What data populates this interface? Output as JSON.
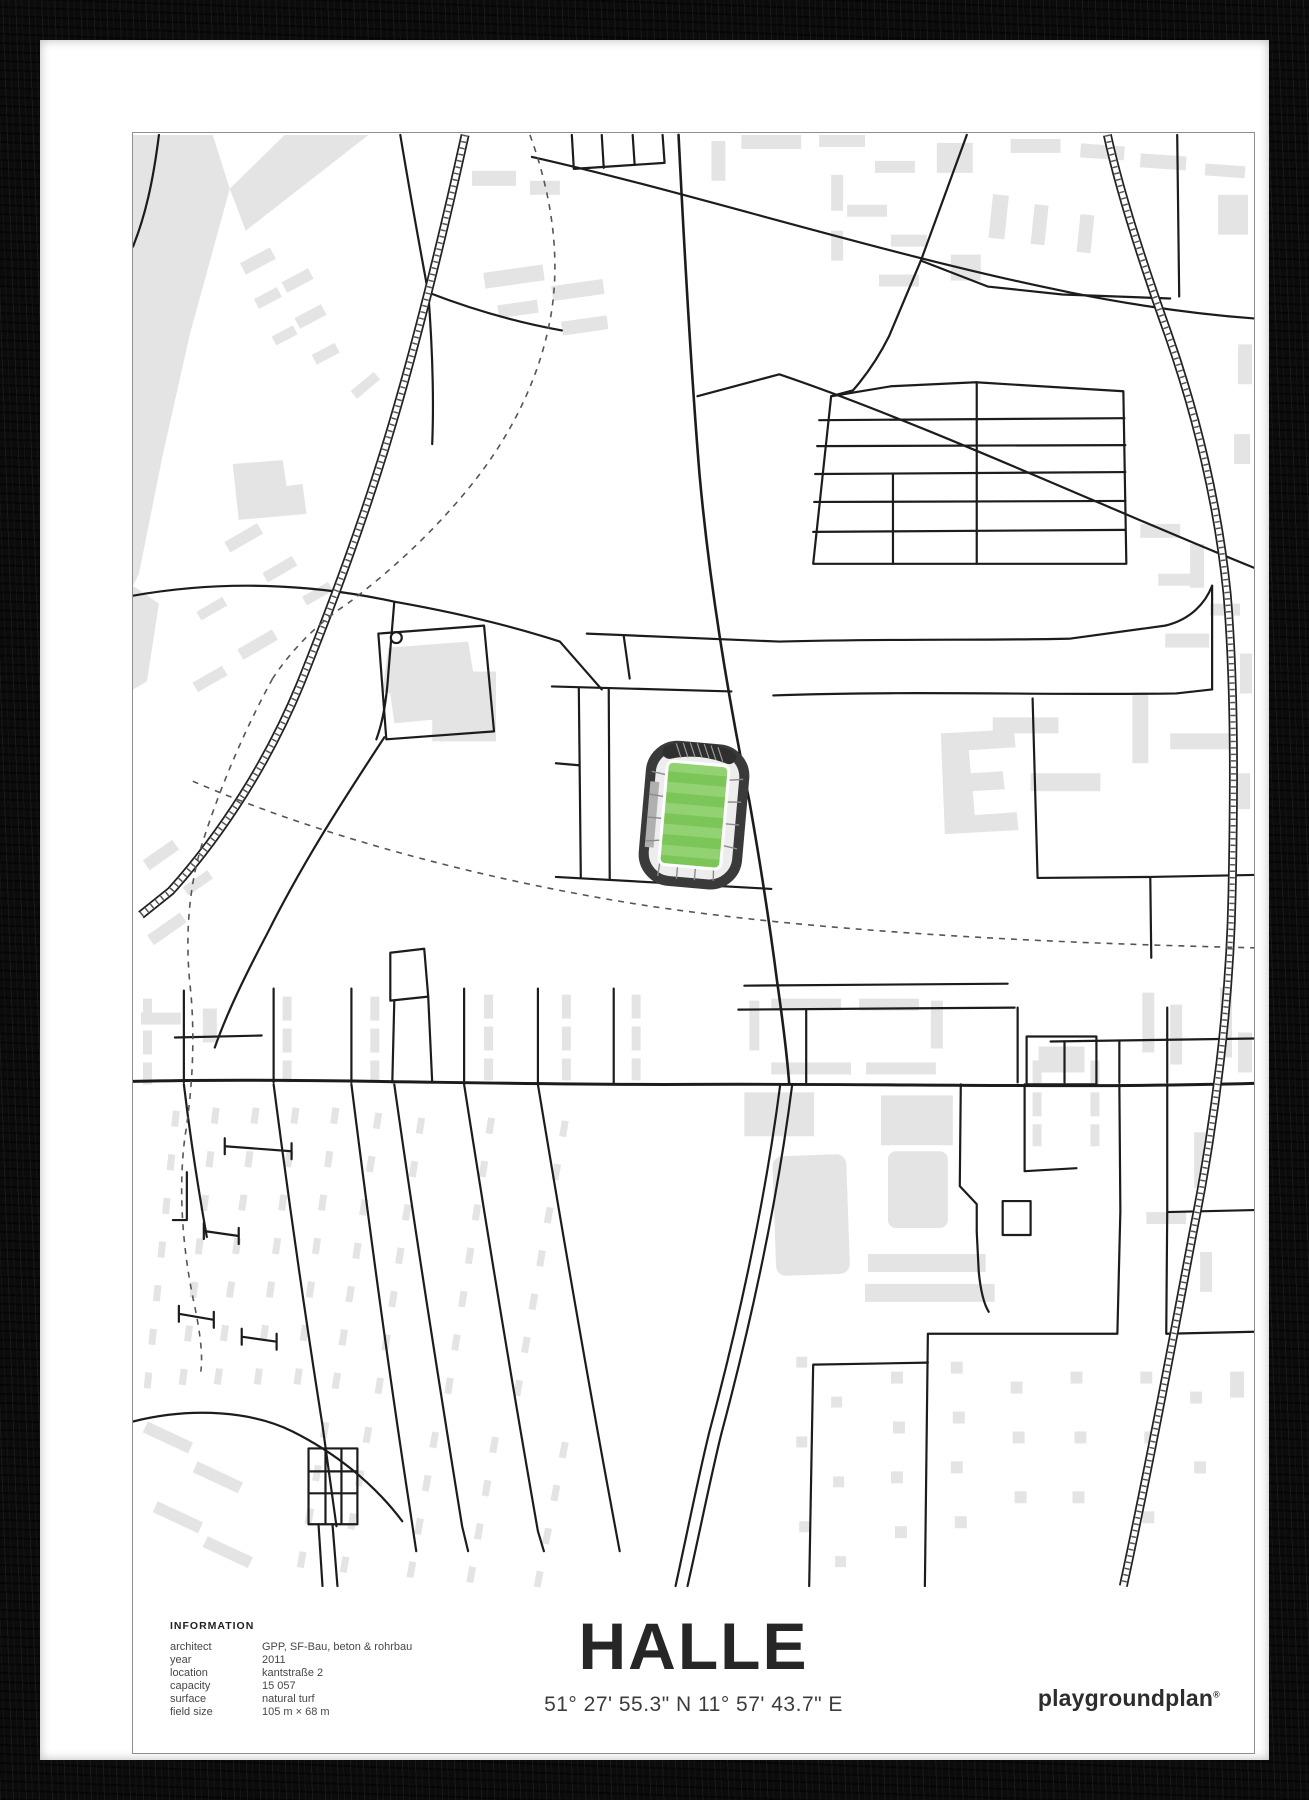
{
  "poster": {
    "title": "HALLE",
    "coordinates": "51° 27' 55.3\" N 11° 57' 43.7\" E",
    "brand": {
      "name": "playgroundplan",
      "registered": "®"
    },
    "information": {
      "heading": "INFORMATION",
      "rows": [
        {
          "label": "architect",
          "value": "GPP, SF-Bau, beton & rohrbau"
        },
        {
          "label": "year",
          "value": "2011"
        },
        {
          "label": "location",
          "value": "kantstraße 2"
        },
        {
          "label": "capacity",
          "value": "15 057"
        },
        {
          "label": "surface",
          "value": "natural turf"
        },
        {
          "label": "field size",
          "value": "105 m × 68 m"
        }
      ]
    }
  },
  "map": {
    "colors": {
      "background": "#FFFFFF",
      "building_fill": "#E4E4E4",
      "street_stroke": "#1C1C1C",
      "dashed_path": "#555555",
      "content_border": "#8F8F8F"
    },
    "stadium": {
      "ring_color": "#3A3A3A",
      "stand_fill": "#EDEDED",
      "stand_side_gray": "#B0B0B0",
      "pitch_green_dark": "#7CC558",
      "pitch_green_light": "#92D272"
    }
  },
  "frame": {
    "color": "#0C0C0C",
    "mat_color": "#FFFFFF"
  }
}
